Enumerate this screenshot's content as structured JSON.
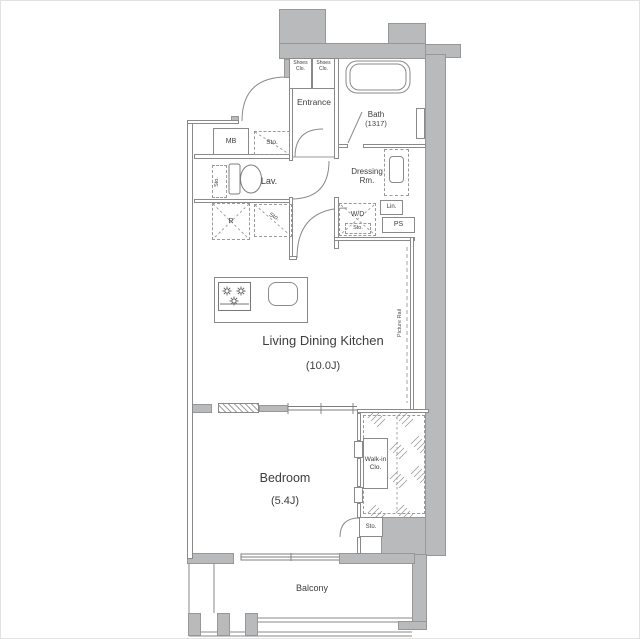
{
  "rooms": {
    "entrance": "Entrance",
    "bath": "Bath",
    "bath_size": "(1317)",
    "dressing_room": "Dressing Rm.",
    "lavatory": "Lav.",
    "living_dining_kitchen": "Living Dining Kitchen",
    "living_dining_kitchen_size": "(10.0J)",
    "bedroom": "Bedroom",
    "bedroom_size": "(5.4J)",
    "walk_in_closet": "Walk-in Clo.",
    "balcony": "Balcony"
  },
  "fixtures": {
    "shoes_closet_left": "Shoes Clo.",
    "shoes_closet_right": "Shoes Clo.",
    "meter_box": "MB",
    "storage_hall": "Sto.",
    "storage_lavatory": "Sto.",
    "storage_kitchen": "Sto.",
    "storage_laundry": "Sto.",
    "storage_walk_in": "Sto.",
    "refrigerator": "R",
    "washer_dryer": "W/D",
    "linen_closet": "Lin.",
    "pipe_space": "PS",
    "picture_rail": "Picture Rail"
  },
  "colors": {
    "wall_fill": "#b9babc",
    "wall_edge": "#979798",
    "line": "#8a8a8a",
    "text": "#3d3d3d"
  }
}
